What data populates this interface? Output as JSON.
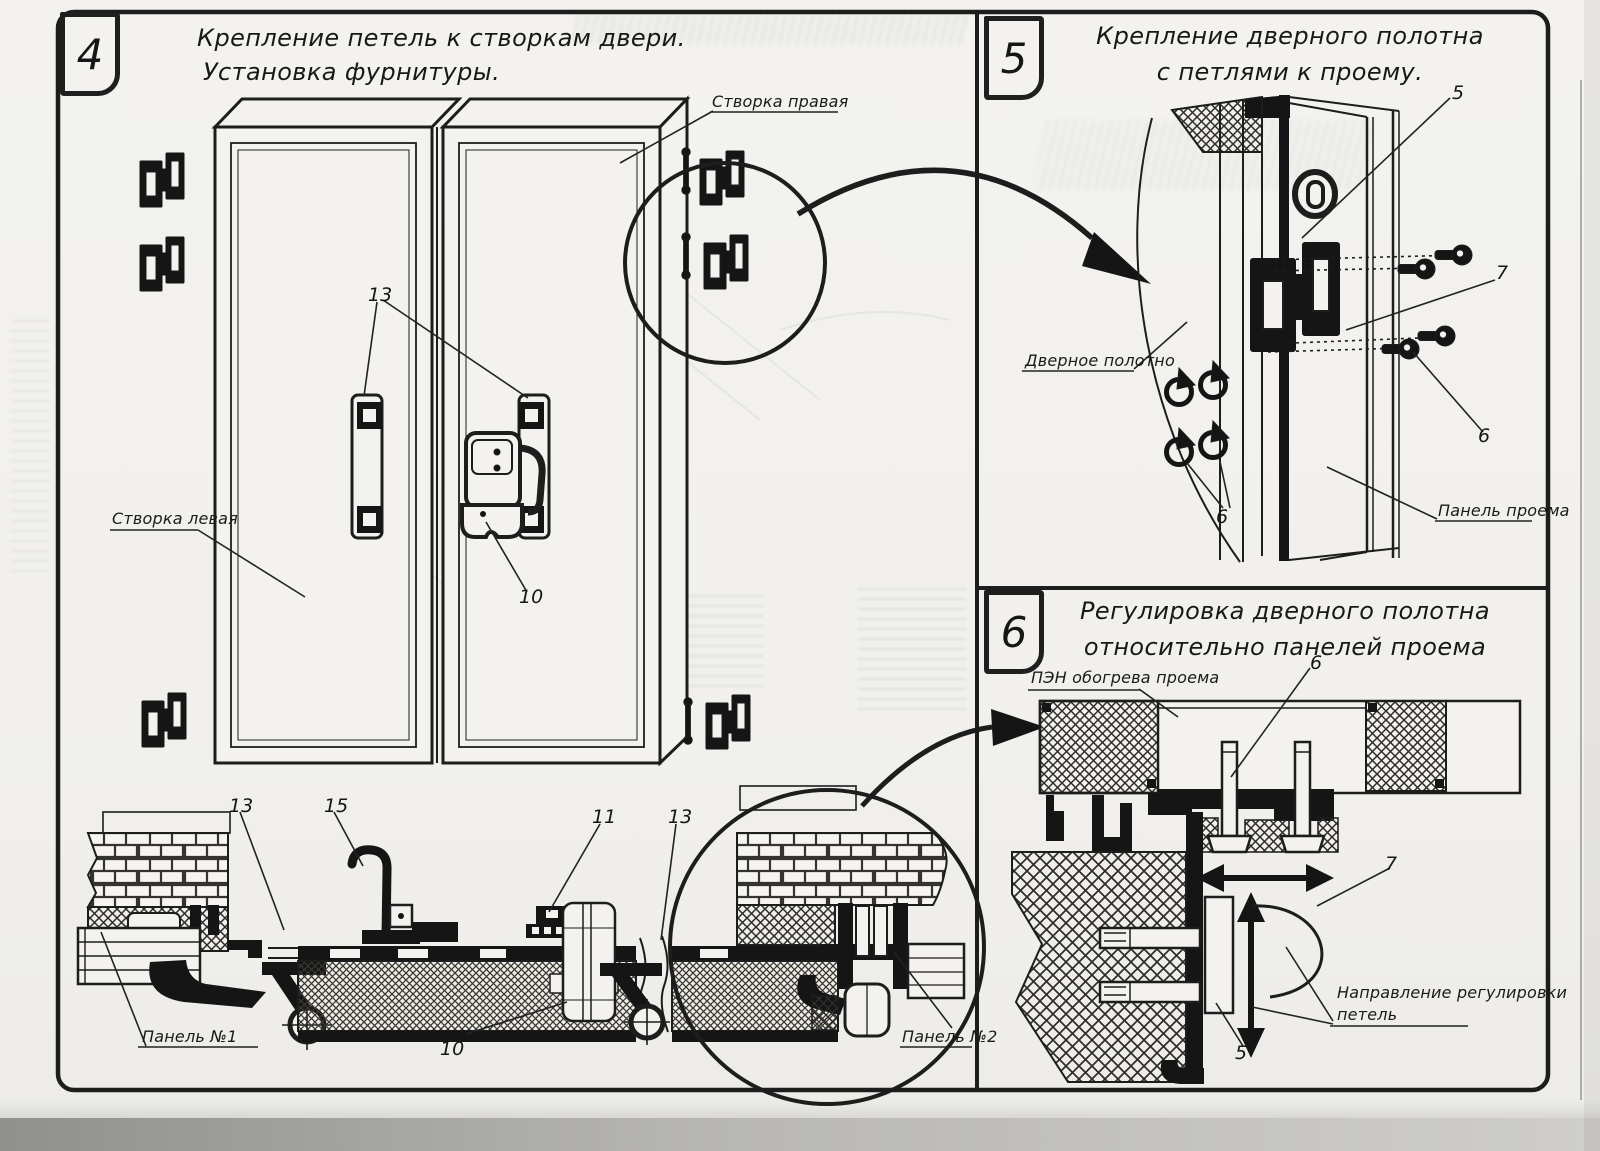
{
  "page": {
    "paper_color": "#f2f1ec",
    "ink_color": "#1d1d1d"
  },
  "panel4": {
    "number": "4",
    "title1": "Крепление петель к створкам двери.",
    "title2": "Установка фурнитуры.",
    "label_right_leaf": "Створка правая",
    "label_left_leaf": "Створка левая",
    "label_panel1": "Панель №1",
    "label_panel2": "Панель №2",
    "callout_handles": "13",
    "callout_latch": "10",
    "callout_section_left": "13",
    "callout_hook": "15",
    "callout_section_profile": "11",
    "callout_section_right": "13",
    "callout_section_latch": "10"
  },
  "panel5": {
    "number": "5",
    "title1": "Крепление дверного полотна",
    "title2": "с петлями к проему.",
    "label_door_leaf": "Дверное полотно",
    "label_opening_panel": "Панель проема",
    "callout_hinge": "5",
    "callout_gasket": "7",
    "callout_screws_right": "6",
    "callout_screws_left": "6"
  },
  "panel6": {
    "number": "6",
    "title1": "Регулировка дверного полотна",
    "title2": "относительно панелей проема",
    "label_heater": "ПЭН обогрева проема",
    "label_direction1": "Направление регулировки",
    "label_direction2": "петель",
    "callout_bolt": "6",
    "callout_hinge_side": "7",
    "callout_bottom": "5"
  }
}
